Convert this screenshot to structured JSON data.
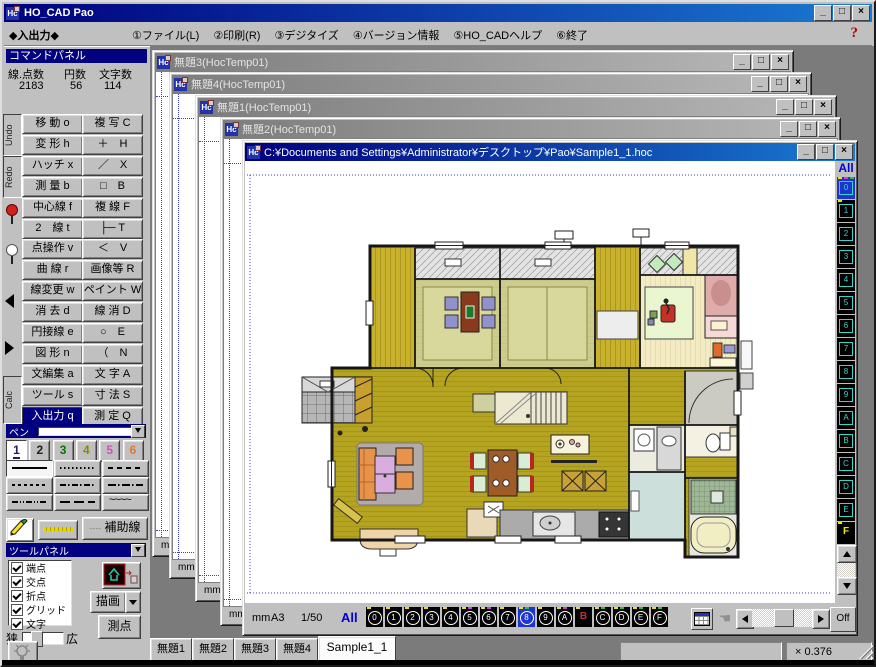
{
  "titlebar": {
    "title": "HO_CAD Pao",
    "controls": {
      "minimize": "_",
      "maximize": "□",
      "close": "×"
    }
  },
  "menubar": {
    "mode_label": "◆入出力◆",
    "items": [
      "①ファイル(L)",
      "②印刷(R)",
      "③デジタイズ",
      "④バージョン情報",
      "⑤HO_CADヘルプ",
      "⑥終了"
    ],
    "help_label": "?"
  },
  "command_panel": {
    "header": "コマンドパネル",
    "stats": {
      "labels": [
        "線.点数",
        "円数",
        "文字数"
      ],
      "values": [
        "2183",
        "56",
        "114"
      ]
    },
    "side": {
      "undo": "Undo",
      "redo": "Redo",
      "calc": "Calc"
    },
    "rows": [
      [
        "移 動 o",
        "複 写 C"
      ],
      [
        "変 形 h",
        "＋　H"
      ],
      [
        "ハッチ x",
        "／　X"
      ],
      [
        "測 量 b",
        "□　B"
      ],
      [
        "中心線 f",
        "複 線 F"
      ],
      [
        "2　線 t",
        "├─ T"
      ],
      [
        "点操作 v",
        "＜　V"
      ],
      [
        "曲 線 r",
        "画像等 R"
      ],
      [
        "線変更 w",
        "ペイント W"
      ],
      [
        "消 去 d",
        "線 消 D"
      ],
      [
        "円接線 e",
        "○　E"
      ],
      [
        "図 形 n",
        "（　N"
      ],
      [
        "文編集 a",
        "文 字 A"
      ],
      [
        "ツール s",
        "寸 法 S"
      ],
      [
        "入出力 q",
        "測 定 Q"
      ]
    ],
    "selected": "入出力 q"
  },
  "pen_panel": {
    "header": "ペン",
    "pens": [
      {
        "label": "1",
        "color": "#202060",
        "selected": true
      },
      {
        "label": "2",
        "color": "#202020",
        "selected": false
      },
      {
        "label": "3",
        "color": "#007800",
        "selected": false
      },
      {
        "label": "4",
        "color": "#8a8a00",
        "selected": false
      },
      {
        "label": "5",
        "color": "#d050c0",
        "selected": false
      },
      {
        "label": "6",
        "color": "#e07830",
        "selected": false
      }
    ],
    "aux_label": "補助線"
  },
  "tool_panel": {
    "header": "ツールパネル",
    "snap_items": [
      "端点",
      "交点",
      "折点",
      "グリッド",
      "文字"
    ],
    "draw_label": "描画",
    "point_label": "測点",
    "narrow_label": "狭",
    "wide_label": "広"
  },
  "mdi": {
    "inactive_windows": [
      {
        "title": "無題3(HocTemp01)",
        "unit": "mm"
      },
      {
        "title": "無題4(HocTemp01)",
        "unit": "mm"
      },
      {
        "title": "無題1(HocTemp01)",
        "unit": "mm"
      },
      {
        "title": "無題2(HocTemp01)",
        "unit": "mm"
      }
    ]
  },
  "active_window": {
    "title": "C:¥Documents and Settings¥Administrator¥デスクトップ¥Pao¥Sample1_1.hoc",
    "status": {
      "unit": "mm",
      "paper": "A3",
      "scale": "1/50",
      "all_label": "All"
    },
    "layers": [
      "0",
      "1",
      "2",
      "3",
      "4",
      "5",
      "6",
      "7",
      "8",
      "9",
      "A",
      "B",
      "C",
      "D",
      "E",
      "F"
    ],
    "selected_bottom": "8",
    "selected_right": "0",
    "plain_bottom": "B",
    "plain_right": "F",
    "off_label": "Off",
    "layer_marks_bottom": {
      "default": [
        "#e8e800"
      ],
      "5": [
        "#e8e800",
        "#cc44cc"
      ],
      "6": [
        "#e8e800",
        "#cc44cc"
      ],
      "8": [
        "#e8e800",
        "#30c030"
      ],
      "A": [
        "#e8e800",
        "#cc44cc"
      ],
      "C": [
        "#e8e800",
        "#30c030"
      ],
      "D": [
        "#e8e800",
        "#30c030"
      ],
      "E": [
        "#e8e800",
        "#30c030"
      ],
      "F": [
        "#e8e800",
        "#30c030"
      ]
    },
    "layer_marks_right": {
      "0": [
        "#e8e800",
        "#cc44cc",
        "#30c030"
      ],
      "1": [
        "#e8e800"
      ],
      "F": [
        "#e8e800"
      ]
    }
  },
  "taskbar": {
    "tabs": [
      {
        "label": "無題1",
        "active": false
      },
      {
        "label": "無題2",
        "active": false
      },
      {
        "label": "無題3",
        "active": false
      },
      {
        "label": "無題4",
        "active": false
      },
      {
        "label": "Sample1_1",
        "active": true
      }
    ],
    "zoom_readout": "× 0.376"
  },
  "palette": {
    "accent_navy": "#000080",
    "titlebar_active_from": "#00007e",
    "titlebar_active_to": "#1a7ad0",
    "mdi_background": "#7b7b7b",
    "layer_teal": "#3ad5c8",
    "layer_selected_blue": "#1d35cf",
    "floor_wood": "#b5a41f",
    "floor_engawa": "#c9b22b",
    "tatami": "#cdcc8f",
    "bedroom_floor": "#f2ebc4",
    "bed_pink": "#dfabab",
    "rug_green": "#eaf6cf",
    "sofa_orange": "#e8924a",
    "bath_blue": "#ccdfdb"
  }
}
